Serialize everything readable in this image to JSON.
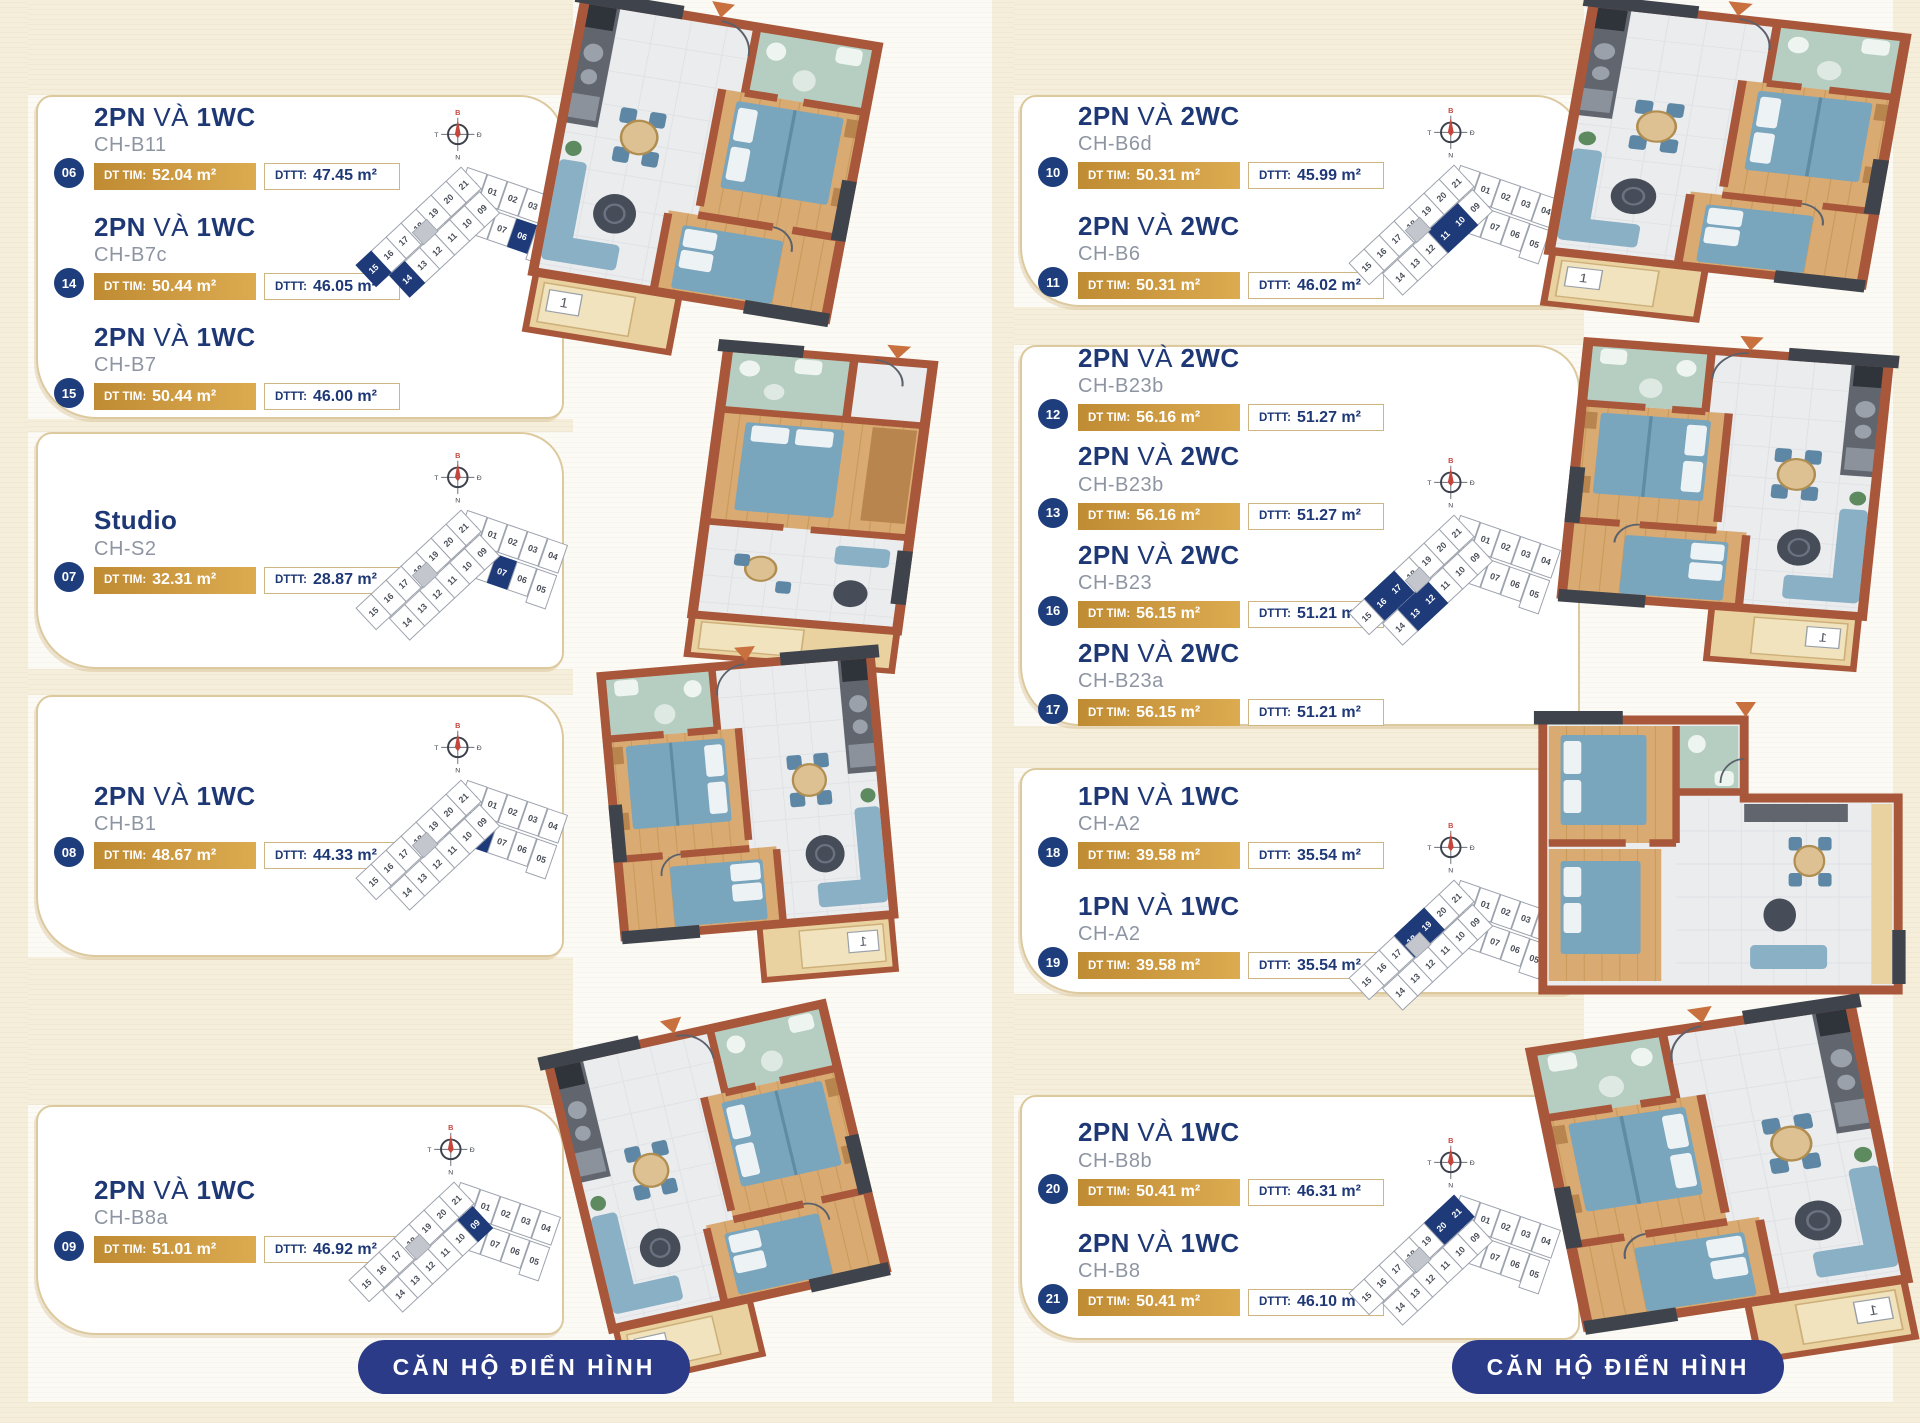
{
  "footer": {
    "label": "CĂN HỘ ĐIỂN HÌNH"
  },
  "labels": {
    "va": "VÀ",
    "dt_tim": "DT TIM:",
    "dttt": "DTTT:"
  },
  "compass": {
    "north": "B",
    "east": "Đ",
    "south": "N",
    "west": "T"
  },
  "keyplan_units": {
    "wingA_top": [
      "22",
      "01",
      "02",
      "03",
      "04"
    ],
    "wingA_bottom": [
      "08",
      "07",
      "06",
      "05"
    ],
    "wingB_top": [
      "21",
      "20",
      "19",
      "18",
      "17",
      "16",
      "15"
    ],
    "wingB_bottom": [
      "09",
      "10",
      "11",
      "12",
      "13",
      "14"
    ]
  },
  "colors": {
    "navy": "#1e3876",
    "gold": "#c8963e",
    "tan_border": "#dcc99e",
    "highlight": "#1e3a78"
  },
  "columns": [
    {
      "groups": [
        {
          "entries": [
            {
              "badge": "06",
              "bed": "2PN",
              "wc": "1WC",
              "code": "CH-B11",
              "dt_tim": "52.04 m²",
              "dttt": "47.45 m²"
            },
            {
              "badge": "14",
              "bed": "2PN",
              "wc": "1WC",
              "code": "CH-B7c",
              "dt_tim": "50.44 m²",
              "dttt": "46.05 m²"
            },
            {
              "badge": "15",
              "bed": "2PN",
              "wc": "1WC",
              "code": "CH-B7",
              "dt_tim": "50.44 m²",
              "dttt": "46.00 m²"
            }
          ]
        },
        {
          "entries": [
            {
              "badge": "07",
              "bed": "Studio",
              "wc": "",
              "code": "CH-S2",
              "dt_tim": "32.31 m²",
              "dttt": "28.87 m²"
            }
          ]
        },
        {
          "entries": [
            {
              "badge": "08",
              "bed": "2PN",
              "wc": "1WC",
              "code": "CH-B1",
              "dt_tim": "48.67 m²",
              "dttt": "44.33 m²"
            }
          ]
        },
        {
          "entries": [
            {
              "badge": "09",
              "bed": "2PN",
              "wc": "1WC",
              "code": "CH-B8a",
              "dt_tim": "51.01 m²",
              "dttt": "46.92 m²"
            }
          ]
        }
      ]
    },
    {
      "groups": [
        {
          "entries": [
            {
              "badge": "10",
              "bed": "2PN",
              "wc": "2WC",
              "code": "CH-B6d",
              "dt_tim": "50.31 m²",
              "dttt": "45.99 m²"
            },
            {
              "badge": "11",
              "bed": "2PN",
              "wc": "2WC",
              "code": "CH-B6",
              "dt_tim": "50.31 m²",
              "dttt": "46.02 m²"
            }
          ]
        },
        {
          "entries": [
            {
              "badge": "12",
              "bed": "2PN",
              "wc": "2WC",
              "code": "CH-B23b",
              "dt_tim": "56.16 m²",
              "dttt": "51.27 m²"
            },
            {
              "badge": "13",
              "bed": "2PN",
              "wc": "2WC",
              "code": "CH-B23b",
              "dt_tim": "56.16 m²",
              "dttt": "51.27 m²"
            },
            {
              "badge": "16",
              "bed": "2PN",
              "wc": "2WC",
              "code": "CH-B23",
              "dt_tim": "56.15 m²",
              "dttt": "51.21 m²"
            },
            {
              "badge": "17",
              "bed": "2PN",
              "wc": "2WC",
              "code": "CH-B23a",
              "dt_tim": "56.15 m²",
              "dttt": "51.21 m²"
            }
          ]
        },
        {
          "entries": [
            {
              "badge": "18",
              "bed": "1PN",
              "wc": "1WC",
              "code": "CH-A2",
              "dt_tim": "39.58 m²",
              "dttt": "35.54 m²"
            },
            {
              "badge": "19",
              "bed": "1PN",
              "wc": "1WC",
              "code": "CH-A2",
              "dt_tim": "39.58 m²",
              "dttt": "35.54 m²"
            }
          ]
        },
        {
          "entries": [
            {
              "badge": "20",
              "bed": "2PN",
              "wc": "1WC",
              "code": "CH-B8b",
              "dt_tim": "50.41 m²",
              "dttt": "46.31 m²"
            },
            {
              "badge": "21",
              "bed": "2PN",
              "wc": "1WC",
              "code": "CH-B8",
              "dt_tim": "50.41 m²",
              "dttt": "46.10 m²"
            }
          ]
        }
      ]
    }
  ]
}
